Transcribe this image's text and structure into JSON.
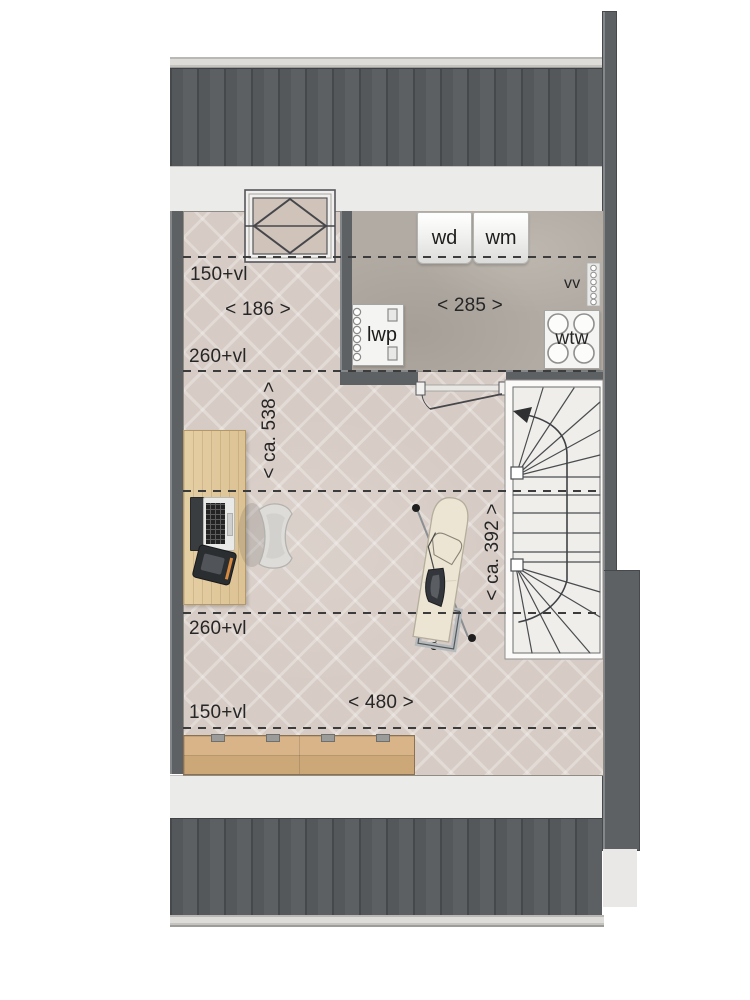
{
  "plan": {
    "utility_labels": {
      "dryer": "wd",
      "washer": "wm",
      "heat_pump": "lwp",
      "heat_recovery": "wtw",
      "vent": "vv"
    },
    "height_markers": {
      "top_150": "150+vl",
      "top_260": "260+vl",
      "bottom_260": "260+vl",
      "bottom_150": "150+vl"
    },
    "dimensions": {
      "left_width": "< 186 >",
      "utility_width": "< 285 >",
      "bottom_width": "< 480 >",
      "left_depth": "< ca. 538 >",
      "right_depth": "< ca. 392 >"
    },
    "colors": {
      "roof": "#54585b",
      "wall": "#5d6164",
      "floor_wood": "#d7ccc5",
      "floor_concrete": "#b2aba3",
      "accent_wood": "#d3ad7f",
      "stairs": "#f0eeeb",
      "band": "#ebebe9",
      "line": "#3c3c3c"
    }
  }
}
